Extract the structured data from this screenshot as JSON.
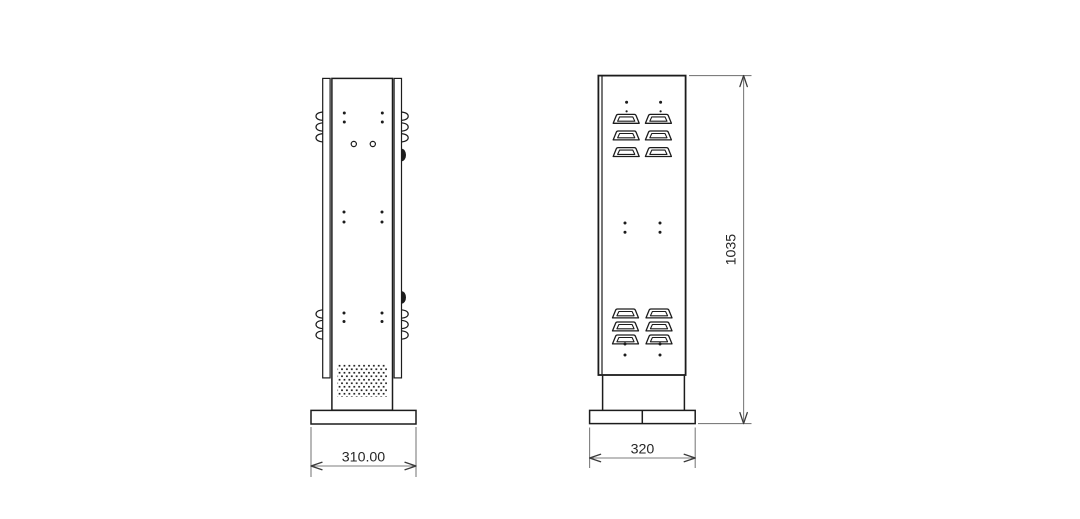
{
  "drawing": {
    "background_color": "#ffffff",
    "line_color": "#1c1c1c",
    "dimension_line_color": "#7e7e7e",
    "dimension_text_color": "#262626",
    "dimensions": {
      "side_base_width": "310.00",
      "front_base_width": "320",
      "front_height": "1035"
    }
  }
}
